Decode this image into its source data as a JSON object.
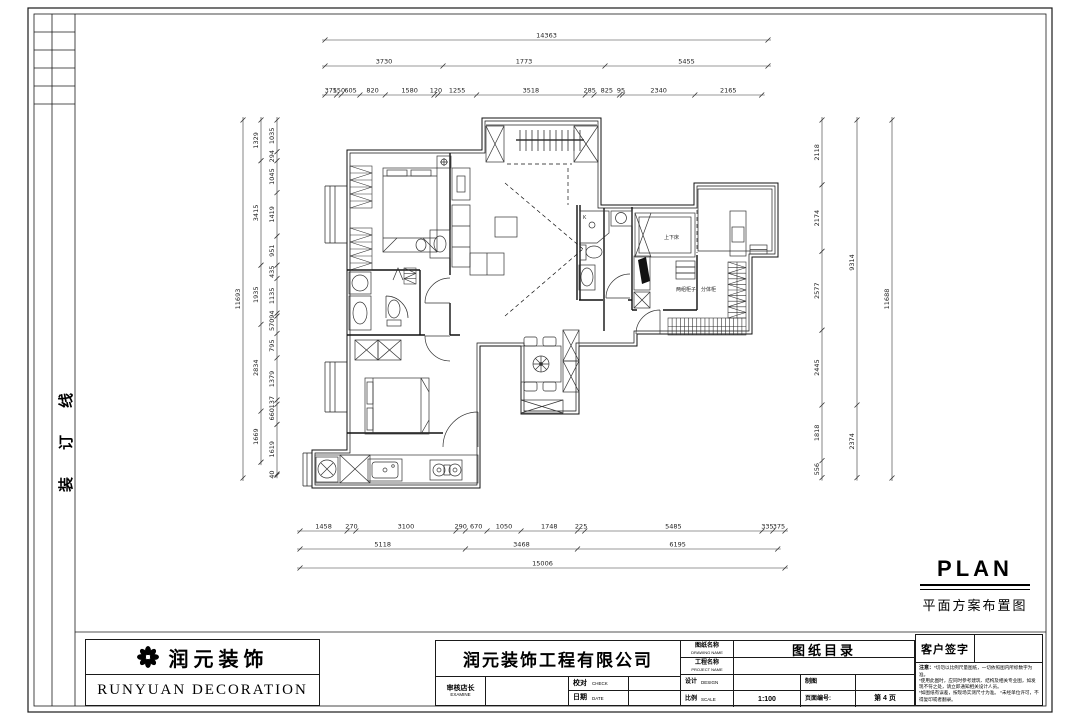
{
  "frame": {
    "binding_chars": [
      "线",
      "订",
      "装"
    ]
  },
  "plan_title": {
    "en": "PLAN",
    "zh": "平面方案布置图"
  },
  "plan_labels": {
    "bunk_bed": "上下床",
    "cabinets": "两组柜子，分体柜",
    "shower_k": "K"
  },
  "dimensions": {
    "top": {
      "total": "14363",
      "mid": [
        "3730",
        "1773",
        "5455"
      ],
      "detail": [
        "375",
        "150",
        "605",
        "820",
        "1580",
        "120",
        "1255",
        "3518",
        "285",
        "825",
        "95",
        "2340",
        "2165"
      ]
    },
    "left": {
      "total": "11693",
      "mid": [
        "1329",
        "3415",
        "1935",
        "2834",
        "1669"
      ],
      "detail": [
        "1035",
        "294",
        "1045",
        "1419",
        "951",
        "435",
        "1135",
        "94",
        "570",
        "795",
        "1379",
        "137",
        "660",
        "1619",
        "40"
      ]
    },
    "right": {
      "detail": [
        "2118",
        "2174",
        "2577",
        "2445",
        "1818",
        "556"
      ],
      "mid": [
        "9314",
        "2374"
      ],
      "total": "11688"
    },
    "bottom": {
      "detail": [
        "1458",
        "270",
        "3100",
        "290",
        "670",
        "1050",
        "1748",
        "225",
        "5485",
        "335",
        "375"
      ],
      "mid": [
        "5118",
        "3468",
        "6195"
      ],
      "total": "15006"
    }
  },
  "title_block": {
    "logo_name": "润元装饰",
    "logo_en": "RUNYUAN DECORATION",
    "company": "润元装饰工程有限公司",
    "fields": {
      "audit_zh": "审核店长",
      "audit_en": "EXAMINE",
      "check_zh": "校对",
      "check_en": "CHECK",
      "date_zh": "日期",
      "date_en": "DATE",
      "drawing_name_zh": "图纸名称",
      "drawing_name_en": "DRAWING NAME",
      "drawing_title": "图纸目录",
      "project_name_zh": "工程名称",
      "project_name_en": "PROJECT NAME",
      "design_zh": "设计",
      "design_en": "DESIGN",
      "draft_zh": "制图",
      "scale_zh": "比例",
      "scale_en": "SCALE",
      "scale_value": "1:100",
      "page_label": "页面编号:",
      "page_value": "第 4 页"
    },
    "customer_sign": "客户签字",
    "notes_label": "注意：",
    "notes": [
      "*切勿以比例尺量图纸，一切依照图内所标数字为准。",
      "*使用此图时，应同时参考建筑、结构及相关专业图，如发现不符之处，请立即通知相关设计人员。",
      "*如图纸有误差，按现场实测尺寸为准。",
      "*未经单位许可，不得复印或者翻录。"
    ]
  }
}
